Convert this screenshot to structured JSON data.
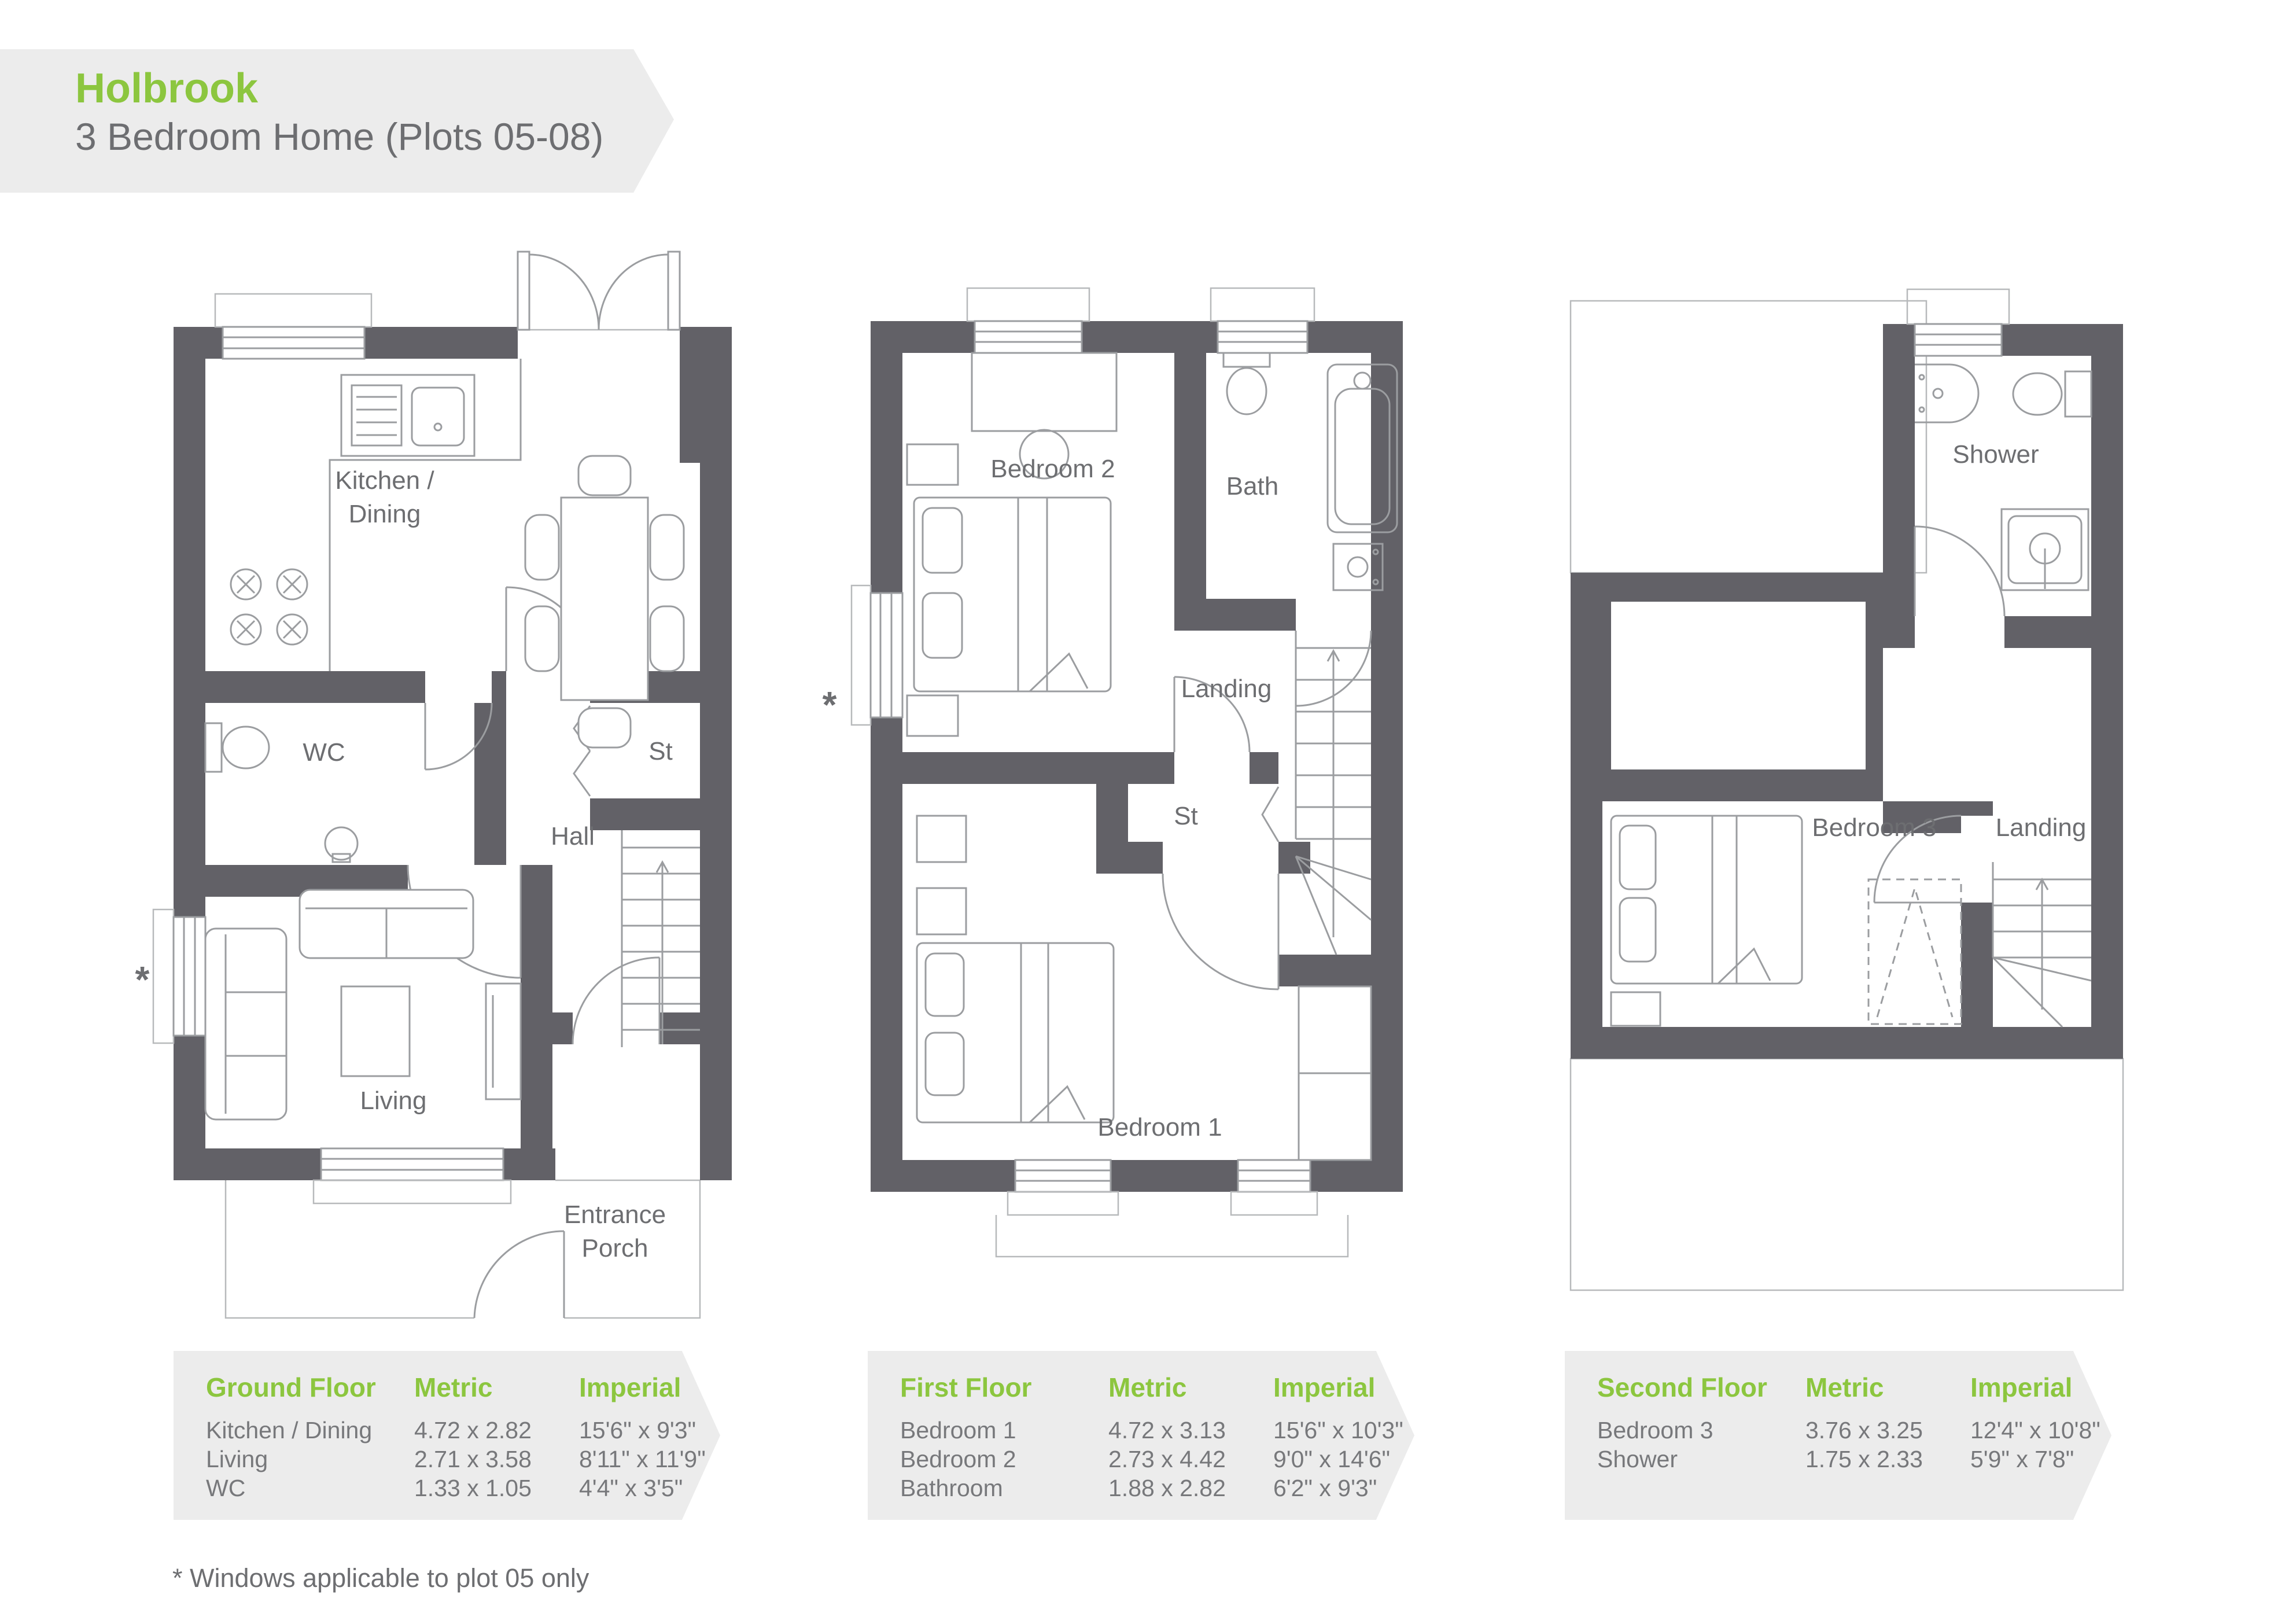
{
  "header": {
    "title": "Holbrook",
    "subtitle": "3 Bedroom Home (Plots 05-08)"
  },
  "plans": {
    "ground": {
      "kitchen_line1": "Kitchen /",
      "kitchen_line2": "Dining",
      "wc": "WC",
      "st": "St",
      "hall": "Hall",
      "living": "Living",
      "entrance_line1": "Entrance",
      "entrance_line2": "Porch",
      "window_note_symbol": "*"
    },
    "first": {
      "bedroom2": "Bedroom 2",
      "bath": "Bath",
      "landing": "Landing",
      "st": "St",
      "bedroom1": "Bedroom 1",
      "window_note_symbol": "*"
    },
    "second": {
      "shower": "Shower",
      "bedroom3": "Bedroom 3",
      "landing": "Landing"
    }
  },
  "tables": [
    {
      "title": "Ground Floor",
      "col_metric": "Metric",
      "col_imperial": "Imperial",
      "rows": [
        {
          "room": "Kitchen / Dining",
          "metric": "4.72 x 2.82",
          "imperial": "15'6\" x 9'3\""
        },
        {
          "room": "Living",
          "metric": "2.71 x 3.58",
          "imperial": "8'11\" x 11'9\""
        },
        {
          "room": "WC",
          "metric": "1.33 x 1.05",
          "imperial": "4'4\" x 3'5\""
        }
      ]
    },
    {
      "title": "First Floor",
      "col_metric": "Metric",
      "col_imperial": "Imperial",
      "rows": [
        {
          "room": "Bedroom 1",
          "metric": "4.72 x 3.13",
          "imperial": "15'6\" x 10'3\""
        },
        {
          "room": "Bedroom 2",
          "metric": "2.73 x 4.42",
          "imperial": "9'0\" x 14'6\""
        },
        {
          "room": "Bathroom",
          "metric": "1.88 x 2.82",
          "imperial": "6'2\" x 9'3\""
        }
      ]
    },
    {
      "title": "Second Floor",
      "col_metric": "Metric",
      "col_imperial": "Imperial",
      "rows": [
        {
          "room": "Bedroom 3",
          "metric": "3.76 x 3.25",
          "imperial": "12'4\" x 10'8\""
        },
        {
          "room": "Shower",
          "metric": "1.75 x 2.33",
          "imperial": "5'9\" x 7'8\""
        }
      ]
    }
  ],
  "footnote": "* Windows applicable to plot 05 only",
  "colors": {
    "accent": "#8cc63f",
    "wall": "#626167",
    "banner": "#ececec",
    "text": "#6d6e71",
    "line": "#9b9da0"
  }
}
